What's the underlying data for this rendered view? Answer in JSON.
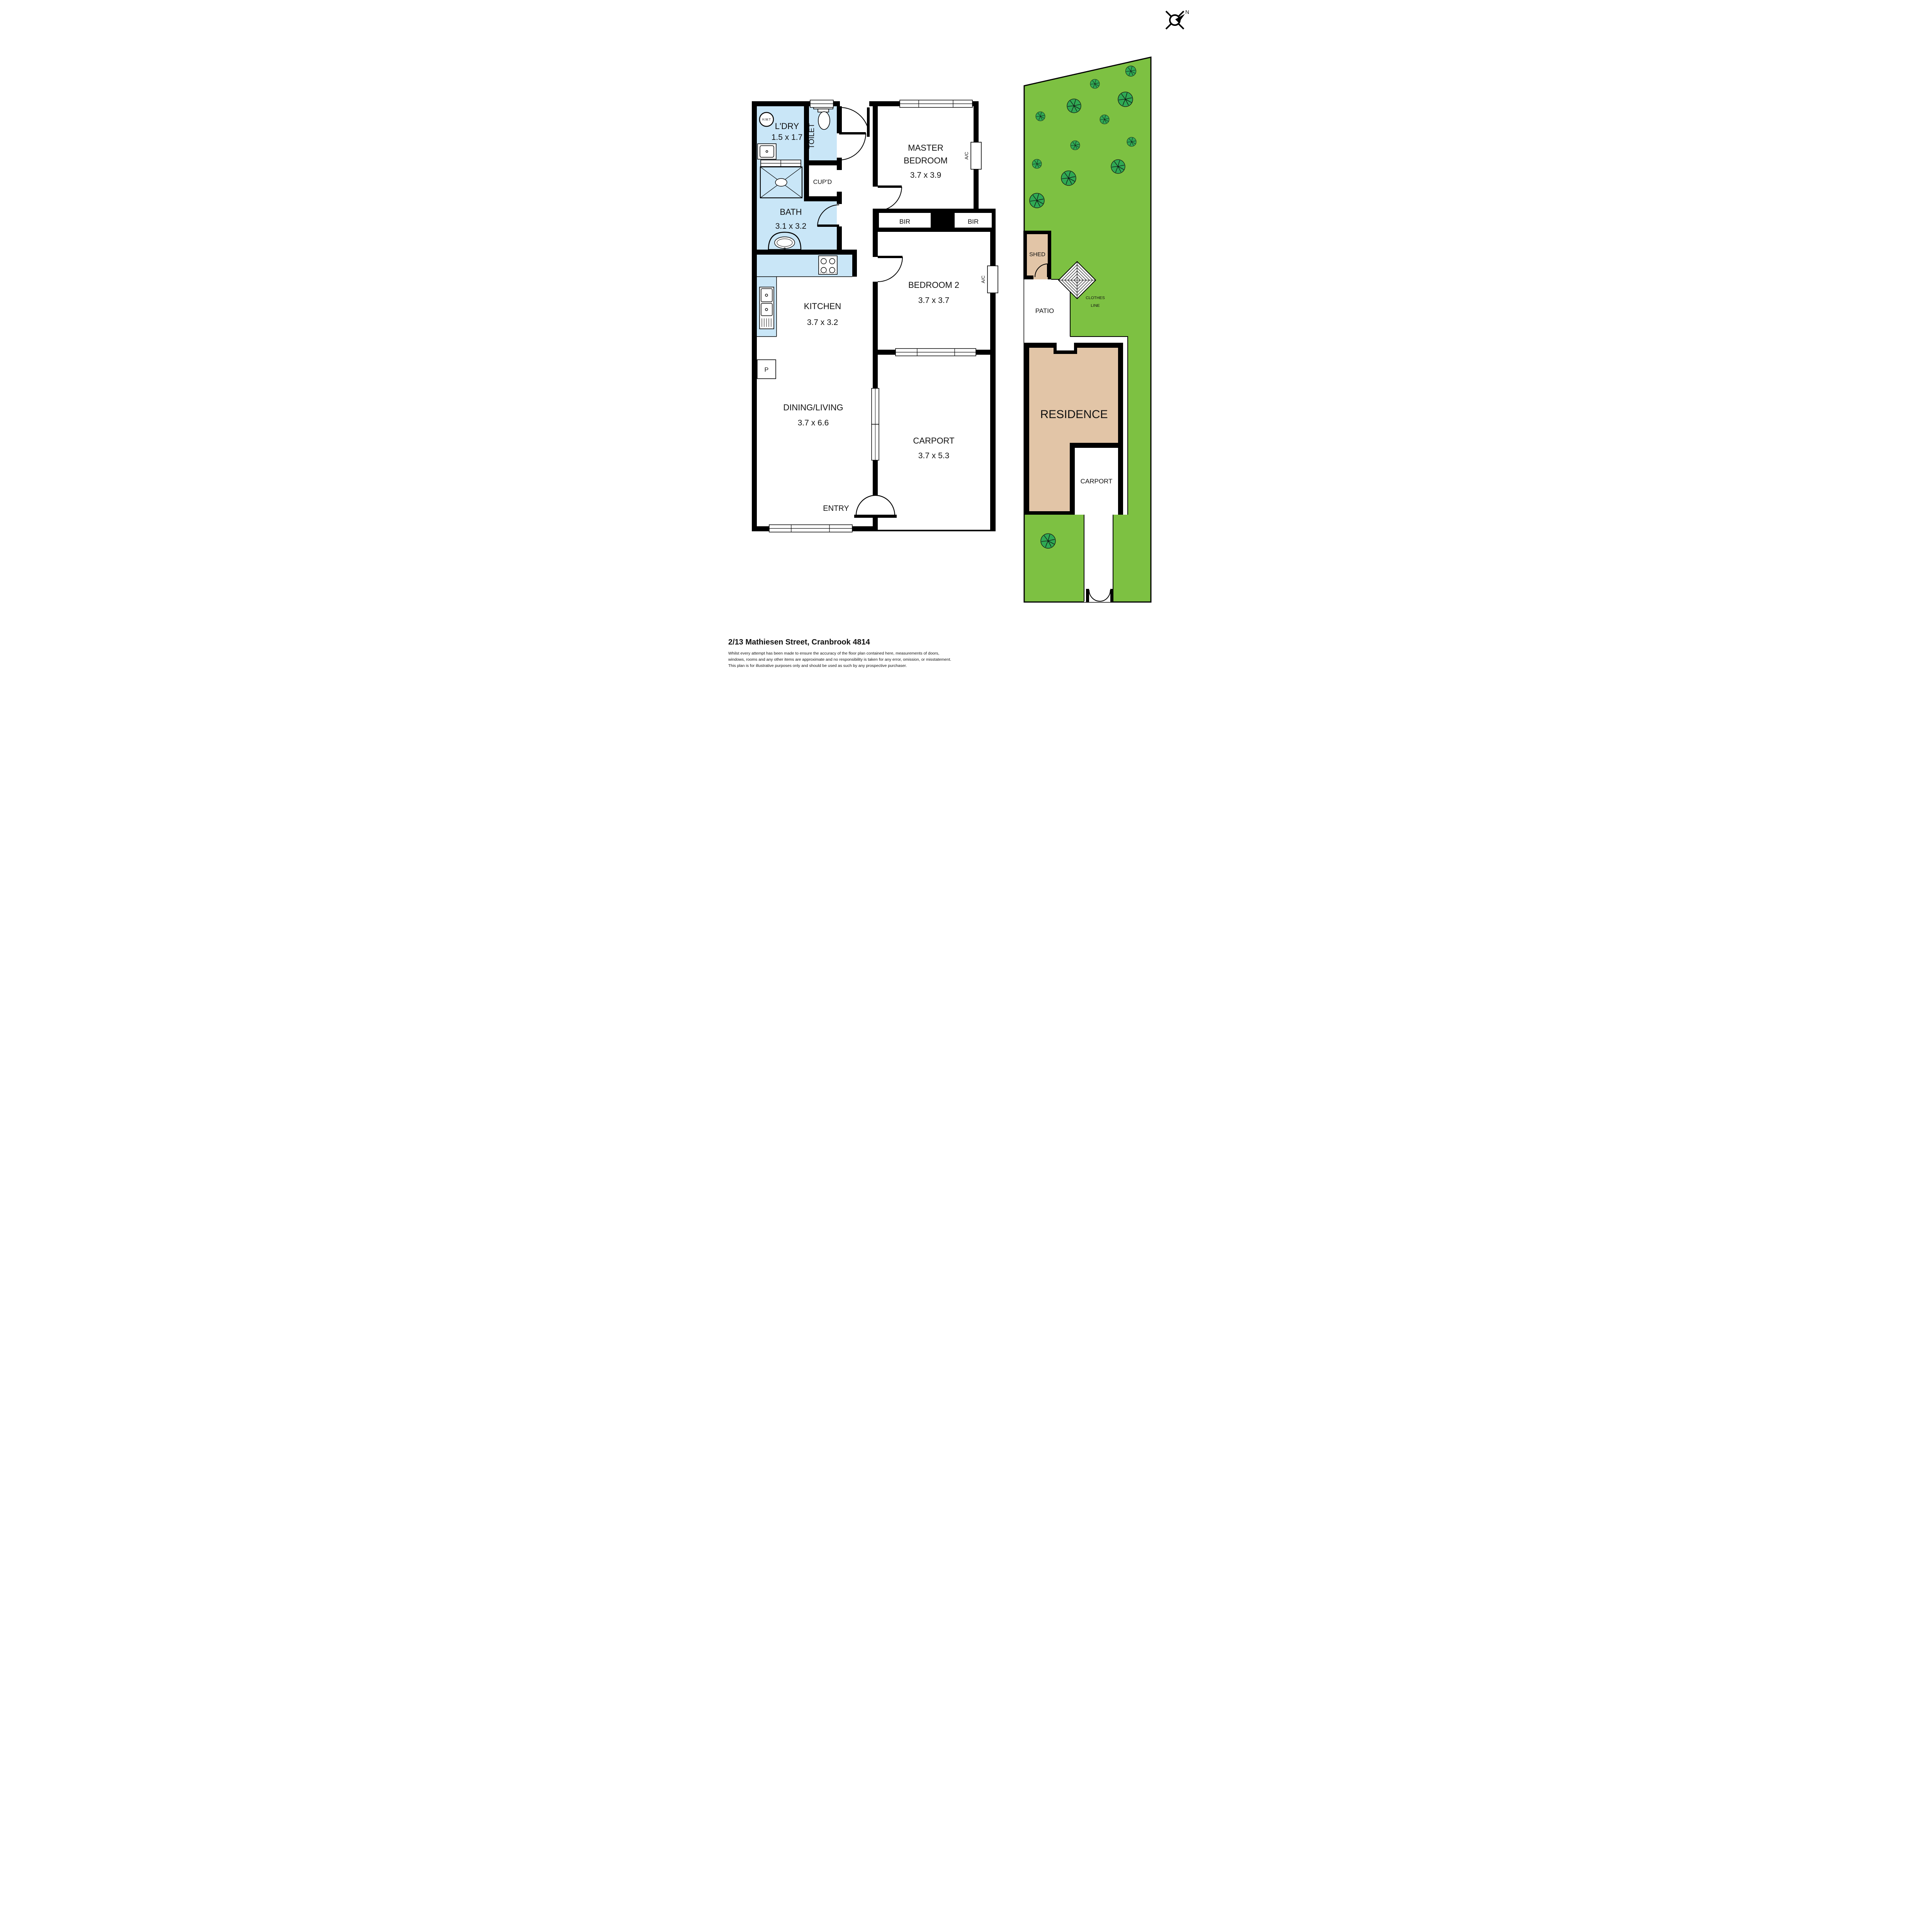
{
  "page": {
    "title": "2/13 Mathiesen Street, Cranbrook 4814",
    "disclaimer": [
      "Whilst every attempt has been made to ensure the accuracy of the floor plan contained here, measurements of doors,",
      "windows, rooms and any other items are approximate and no responsibility is taken for any error, omission, or misstatement.",
      "This plan is for illustrative purposes only and should be used as such by any prospective purchaser."
    ]
  },
  "compass": {
    "north": "N"
  },
  "floor_plan": {
    "laundry": {
      "name": "L'DRY",
      "dims": "1.5 x 1.7"
    },
    "toilet": {
      "name": "TOILET"
    },
    "cupboard": {
      "name": "CUP'D"
    },
    "bath": {
      "name": "BATH",
      "dims": "3.1 x 3.2"
    },
    "kitchen": {
      "name": "KITCHEN",
      "dims": "3.7 x 3.2"
    },
    "master": {
      "line1": "MASTER",
      "line2": "BEDROOM",
      "dims": "3.7 x 3.9"
    },
    "bedroom2": {
      "name": "BEDROOM 2",
      "dims": "3.7 x 3.7"
    },
    "dining": {
      "name": "DINING/LIVING",
      "dims": "3.7 x 6.6"
    },
    "carport": {
      "name": "CARPORT",
      "dims": "3.7 x 5.3"
    },
    "entry": {
      "name": "ENTRY"
    },
    "hot_water": "H.W.T",
    "bir": "BIR",
    "ac": "A/C",
    "pantry": "P"
  },
  "site_plan": {
    "shed": "SHED",
    "patio": "PATIO",
    "residence": "RESIDENCE",
    "carport": "CARPORT",
    "clothes_line": {
      "line1": "CLOTHES",
      "line2": "LINE"
    }
  },
  "colors": {
    "wall": "#000000",
    "wet_area": "#C9E6F7",
    "lawn": "#7DC142",
    "tree": "#2FA953",
    "building": "#E2C5A7"
  }
}
